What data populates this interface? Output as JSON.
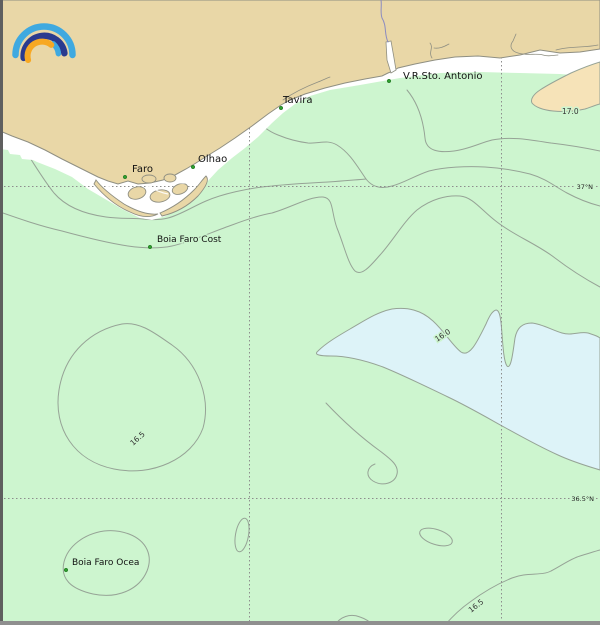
{
  "map": {
    "type": "sea-surface-temperature-chart",
    "logo": {
      "name": "meteoblue-rainbow-logo"
    },
    "colors": {
      "land": "#e9d7a7",
      "sea_band_green": "#cdf5cf",
      "sea_band_blue": "#ddf3f8",
      "sea_band_cream": "#f6e3b8",
      "beach_white": "#ffffff",
      "contour_line": "#96a396",
      "coast_line": "#8f8f82",
      "grid_line": "#8d8d8d",
      "marker_green": "#2f9e2f",
      "river_blue": "#8b8bc0",
      "logo_cyan": "#3fa9e0",
      "logo_navy": "#2a3b8f",
      "logo_orange": "#f7a823"
    },
    "places": [
      {
        "name": "Faro"
      },
      {
        "name": "Olhao"
      },
      {
        "name": "Tavira"
      },
      {
        "name": "V.R.Sto. Antonio"
      }
    ],
    "buoys": [
      {
        "name": "Boia Faro Cost"
      },
      {
        "name": "Boia Faro Ocea"
      }
    ],
    "graticule": {
      "latitudes": [
        {
          "label": "37°N"
        },
        {
          "label": "36.5°N"
        }
      ]
    },
    "isotherm_labels": [
      {
        "value": "17.0"
      },
      {
        "value": "16.0"
      },
      {
        "value": "16.5"
      },
      {
        "value": "16.5"
      }
    ]
  }
}
